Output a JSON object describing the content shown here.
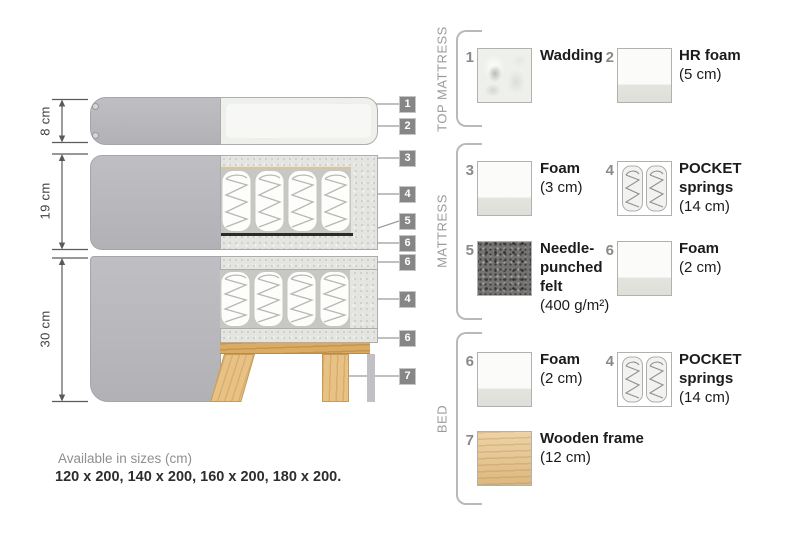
{
  "diagram": {
    "dimensions": [
      {
        "label": "8 cm"
      },
      {
        "label": "19 cm"
      },
      {
        "label": "30 cm"
      }
    ],
    "callouts": [
      "1",
      "2",
      "3",
      "4",
      "5",
      "6",
      "6",
      "4",
      "6",
      "7"
    ]
  },
  "sections": [
    {
      "label": "TOP MATTRESS"
    },
    {
      "label": "MATTRESS"
    },
    {
      "label": "BED"
    }
  ],
  "legend": {
    "items": [
      {
        "num": "1",
        "title": "Wadding",
        "subtitle": "",
        "swatch": "wadding"
      },
      {
        "num": "2",
        "title": "HR foam",
        "subtitle": "(5 cm)",
        "swatch": "foam"
      },
      {
        "num": "3",
        "title": "Foam",
        "subtitle": "(3 cm)",
        "swatch": "foam"
      },
      {
        "num": "4",
        "title": "POCKET springs",
        "subtitle": "(14 cm)",
        "swatch": "pocket-springs"
      },
      {
        "num": "5",
        "title": "Needle-punched felt",
        "subtitle": "(400 g/m²)",
        "swatch": "felt"
      },
      {
        "num": "6",
        "title": "Foam",
        "subtitle": "(2 cm)",
        "swatch": "foam"
      },
      {
        "num": "6",
        "title": "Foam",
        "subtitle": "(2 cm)",
        "swatch": "foam"
      },
      {
        "num": "4",
        "title": "POCKET springs",
        "subtitle": "(14 cm)",
        "swatch": "pocket-springs"
      },
      {
        "num": "7",
        "title": "Wooden frame",
        "subtitle": "(12 cm)",
        "swatch": "wood"
      }
    ]
  },
  "footer": {
    "line1": "Available in sizes (cm)",
    "line2": "120 x 200, 140 x 200, 160 x 200, 180 x 200."
  },
  "colors": {
    "fabric_gray": "#b8b8bc",
    "foam_speckle": "#e4e4e1",
    "badge_bg": "#868686",
    "wood": "#e8c285",
    "felt_dark": "#757371",
    "label_text": "#1b1b19",
    "muted_text": "#9b9b9b"
  }
}
